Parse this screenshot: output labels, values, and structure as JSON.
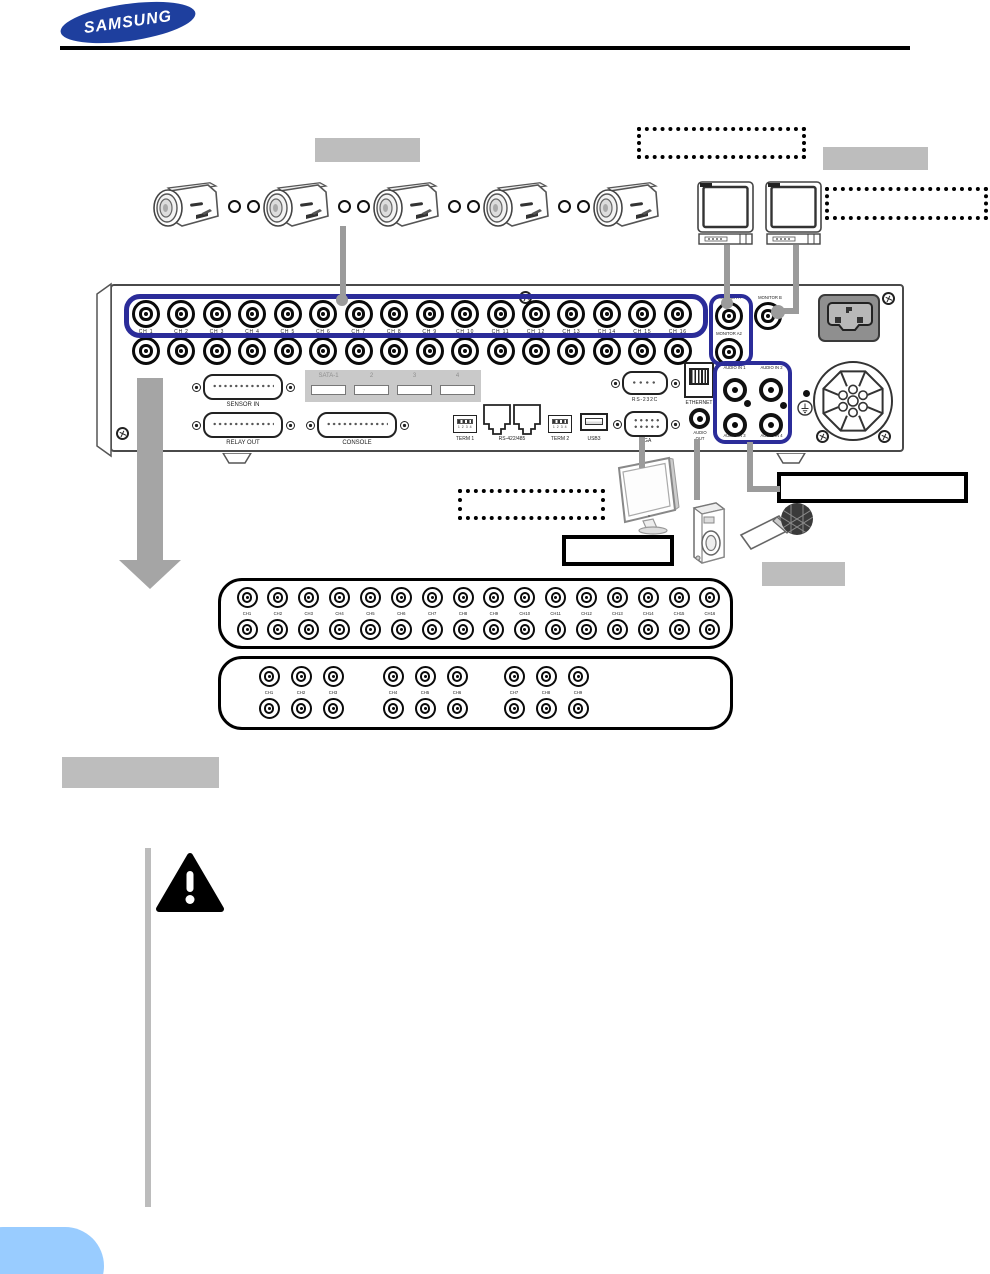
{
  "logo": {
    "text": "SAMSUNG"
  },
  "colors": {
    "samsung_blue": "#1e3f9e",
    "highlight_blue": "#2b2c99",
    "line_gray": "#9b9b9b",
    "arrow_gray": "#a5a5a5",
    "note_bar_gray": "#bcbcbc",
    "callout_gray": "#bdbdbd",
    "sata_gray": "#c9c9c9",
    "pill_blue": "#99ccff"
  },
  "rear_panel": {
    "video_channels": [
      "CH 1",
      "CH 2",
      "CH 3",
      "CH 4",
      "CH 5",
      "CH 6",
      "CH 7",
      "CH 8",
      "CH 9",
      "CH 10",
      "CH 11",
      "CH 12",
      "CH 13",
      "CH 14",
      "CH 15",
      "CH 16"
    ],
    "monitor_a": "MONITOR A",
    "monitor_b": "MONITOR B",
    "monitor_a2": "MONITOR A2",
    "sensor_in": "SENSOR IN",
    "relay_out": "RELAY OUT",
    "console": "CONSOLE",
    "sata": [
      "SATA-1",
      "2",
      "3",
      "4"
    ],
    "term1": "TERM 1",
    "rs422": "RS-422/485",
    "term2": "TERM 2",
    "usb": "USB3",
    "term_pins": "1 2 3 4",
    "rs232": "RS-232C",
    "ethernet": "ETHERNET",
    "vga": "VGA",
    "audio_out": [
      "AUDIO",
      "OUT"
    ],
    "audio_in_top": [
      "AUDIO IN 1",
      "AUDIO IN 2"
    ],
    "audio_in_bottom": [
      "AUDIO IN 3",
      "AUDIO IN 4"
    ]
  },
  "loop16": {
    "channels": [
      "CH1",
      "CH2",
      "CH3",
      "CH4",
      "CH5",
      "CH6",
      "CH7",
      "CH8",
      "CH9",
      "CH10",
      "CH11",
      "CH12",
      "CH13",
      "CH14",
      "CH15",
      "CH16"
    ]
  },
  "loop9": {
    "groups": [
      [
        "CH1",
        "CH2",
        "CH3"
      ],
      [
        "CH4",
        "CH5",
        "CH6"
      ],
      [
        "CH7",
        "CH8",
        "CH9"
      ]
    ]
  }
}
